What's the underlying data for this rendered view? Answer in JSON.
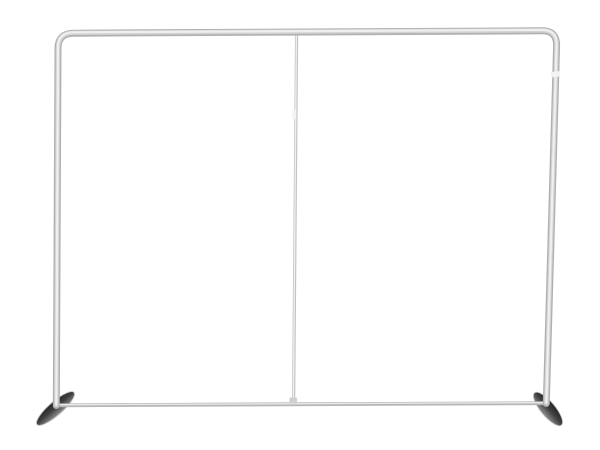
{
  "scene": {
    "description": "Product photo of an empty silver aluminum tube backdrop frame (tension fabric display stand) with a center support pole and two dark angled stabilizer feet, on a plain white background",
    "background_color": "#ffffff"
  },
  "frame": {
    "tube_base_color": "#b0b0b0",
    "tube_mid_color": "#d2d2d2",
    "tube_highlight_color": "#efefef",
    "bottom_bar_base_color": "#b6b6b6",
    "bottom_bar_highlight_color": "#e8e8e8",
    "center_pole_base_color": "#c4c4c4",
    "center_pole_highlight_color": "#f0f0f0",
    "joint_color": "#f3f3f3",
    "fitting_color": "#cfcfcf"
  },
  "feet": {
    "top_color": "#262626",
    "mid_color": "#3f3f3f",
    "light_color": "#909090",
    "rim_color": "#c6c6c6"
  }
}
